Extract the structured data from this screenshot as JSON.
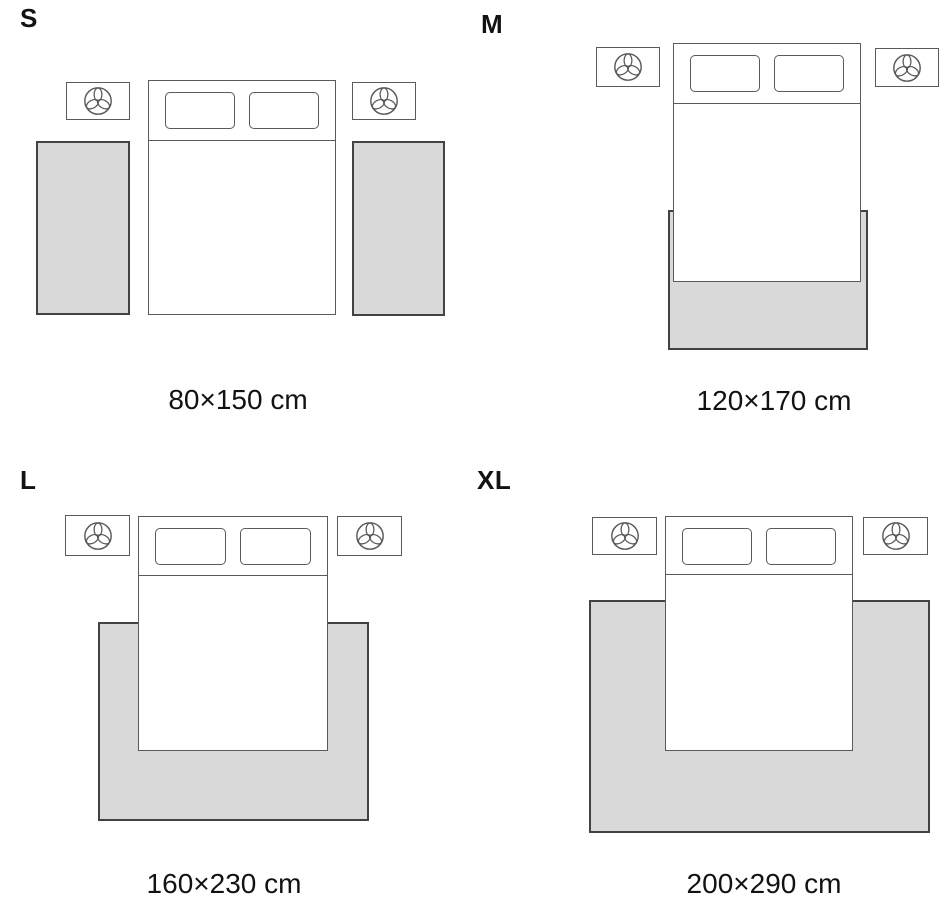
{
  "colors": {
    "background": "#ffffff",
    "rug_fill": "#d9d9d9",
    "outline": "#424242",
    "outline_soft": "#5a5a5a",
    "text": "#121212"
  },
  "icons": {
    "nightstand_decor": "plant-icon"
  },
  "panels": [
    {
      "id": "s",
      "label": "S",
      "size_caption": "80×150 cm",
      "layout": "two side runner rugs beside bed"
    },
    {
      "id": "m",
      "label": "M",
      "size_caption": "120×170 cm",
      "layout": "rug under foot of bed"
    },
    {
      "id": "l",
      "label": "L",
      "size_caption": "160×230 cm",
      "layout": "large rug under lower two-thirds of bed"
    },
    {
      "id": "xl",
      "label": "XL",
      "size_caption": "200×290 cm",
      "layout": "extra large rug spanning bed and nightstand width"
    }
  ]
}
